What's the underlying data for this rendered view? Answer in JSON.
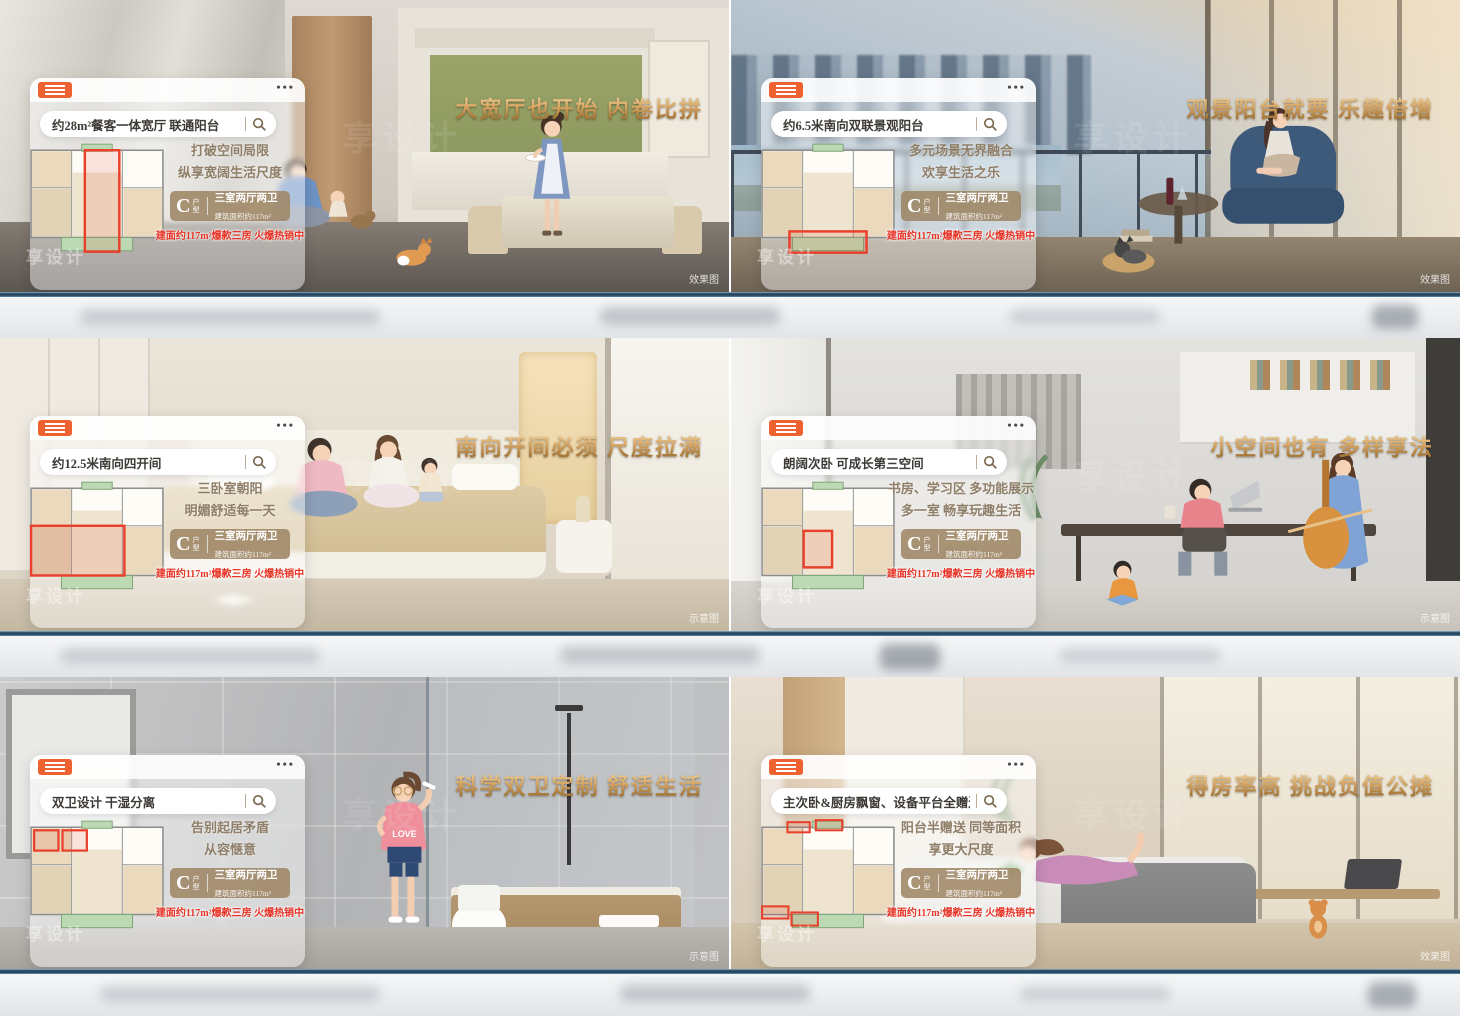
{
  "brand": "享设计",
  "colors": {
    "accent_orange": "#ED6230",
    "headline_gold": "#C9964E",
    "promo_red": "#E73427",
    "badge_tan": "#9E8665",
    "divider_blue": "#2E5068"
  },
  "icons": {
    "menu": "hamburger-menu-icon",
    "more_dots": "•••",
    "search": "magnifier-icon"
  },
  "shared": {
    "badge_letter": "C",
    "badge_type": "户型",
    "badge_layout": "三室两厅两卫",
    "badge_area": "建筑面积约117m²",
    "promo": "建面约117m²爆款三房 火爆热销中"
  },
  "panels": [
    {
      "headline": "大宽厅也开始 内卷比拼",
      "search": "约28m²餐客一体宽厅 联通阳台",
      "tagline1": "打破空间局限",
      "tagline2": "纵享宽阔生活尺度",
      "photo_tag": "效果图"
    },
    {
      "headline": "观景阳台就要 乐趣倍增",
      "search": "约6.5米南向双联景观阳台",
      "tagline1": "多元场景无界融合",
      "tagline2": "欢享生活之乐",
      "photo_tag": "效果图"
    },
    {
      "headline": "南向开间必须 尺度拉满",
      "search": "约12.5米南向四开间",
      "tagline1": "三卧室朝阳",
      "tagline2": "明媚舒适每一天",
      "photo_tag": "示意图"
    },
    {
      "headline": "小空间也有 多样享法",
      "search": "朗阔次卧 可成长第三空间",
      "tagline1": "书房、学习区 多功能展示",
      "tagline2": "多一室 畅享玩趣生活",
      "photo_tag": "示意图"
    },
    {
      "headline": "科学双卫定制 舒适生活",
      "search": "双卫设计 干湿分离",
      "tagline1": "告别起居矛盾",
      "tagline2": "从容惬意",
      "photo_tag": "示意图"
    },
    {
      "headline": "得房率高 挑战负值公摊",
      "search": "主次卧&厨房飘窗、设备平台全赠送",
      "tagline1": "阳台半赠送 同等面积",
      "tagline2": "享更大尺度",
      "photo_tag": "效果图"
    }
  ]
}
